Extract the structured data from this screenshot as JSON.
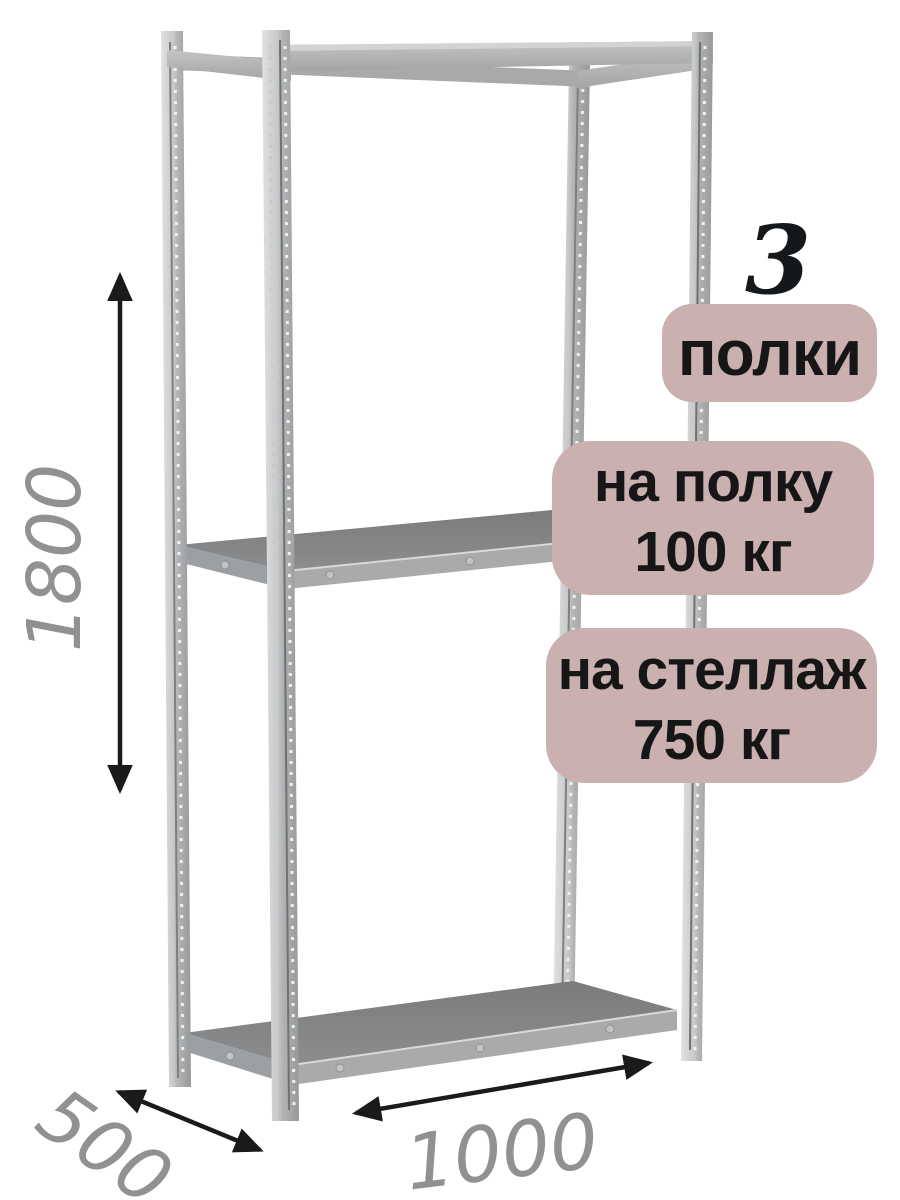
{
  "image_type": "shelving rack product dimension diagram",
  "badges": {
    "count_number": "3",
    "count_label": "полки",
    "per_shelf": {
      "line1": "на полку",
      "line2": "100 кг"
    },
    "per_rack": {
      "line1": "на стеллаж",
      "line2": "750 кг"
    },
    "bg_color": "#cbb0b0",
    "text_color": "#161616"
  },
  "dimensions": {
    "height_mm": "1800",
    "depth_mm": "500",
    "width_mm": "1000",
    "label_color": "#8f9193",
    "arrow_color": "#1a1a1a"
  },
  "rack": {
    "shelf_count": 3,
    "colors": {
      "frame": "#b6b8ba",
      "frame_highlight": "#e4e5e6",
      "shelf_top": "#828486",
      "shelf_edge": "#a8aaac"
    }
  }
}
